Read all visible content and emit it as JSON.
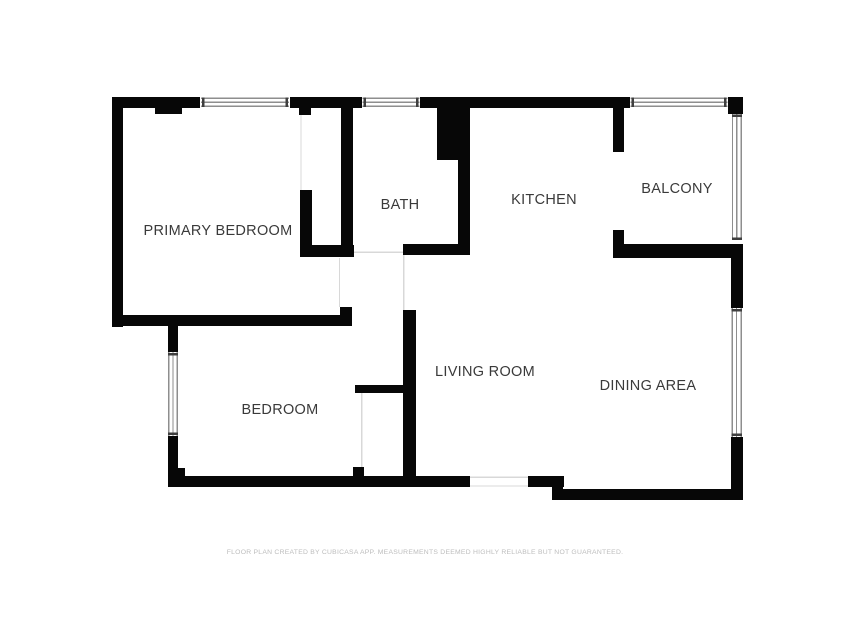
{
  "rooms": {
    "primary_bedroom": "PRIMARY BEDROOM",
    "bath": "BATH",
    "kitchen": "KITCHEN",
    "balcony": "BALCONY",
    "bedroom": "BEDROOM",
    "living_room": "LIVING ROOM",
    "dining_area": "DINING AREA"
  },
  "footer": "FLOOR PLAN CREATED BY CUBICASA APP. MEASUREMENTS DEEMED HIGHLY RELIABLE BUT NOT GUARANTEED.",
  "colors": {
    "background": "#ffffff",
    "wall": "#070707",
    "room_label": "#3a3a3a",
    "footer_text": "#bdbdbd",
    "window_line": "#8e8e8e",
    "window_cap": "#3f3f3f",
    "door_line": "#d8d8d8"
  }
}
